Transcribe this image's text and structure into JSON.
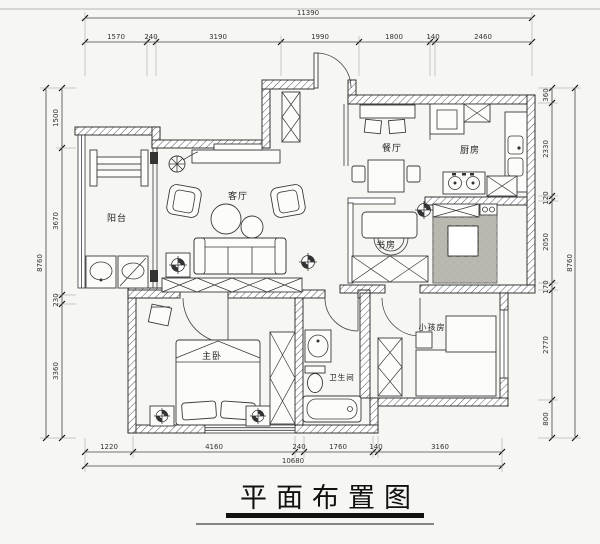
{
  "title": {
    "text": "平面布置图"
  },
  "rooms": {
    "balcony": "阳台",
    "living": "客厅",
    "dining": "餐厅",
    "kitchen": "厨房",
    "study": "书房",
    "master_bedroom": "主卧",
    "bathroom": "卫生间",
    "kids_room": "小孩房"
  },
  "dimensions": {
    "top": {
      "total": "11390",
      "segments": [
        "1570",
        "240",
        "3190",
        "1990",
        "1800",
        "140",
        "2460"
      ]
    },
    "bottom": {
      "total": "10680",
      "segments": [
        "1220",
        "4160",
        "240",
        "1760",
        "140",
        "3160"
      ]
    },
    "left": {
      "total": "8760",
      "segments": [
        "1500",
        "3670",
        "230",
        "3360"
      ]
    },
    "right": {
      "total": "8760",
      "segments": [
        "360",
        "2330",
        "120",
        "2050",
        "170",
        "2770",
        "800"
      ]
    }
  },
  "colors": {
    "ink": "#2b2b2b",
    "paper": "#f6f6f3",
    "tile_fill": "#e0ded6",
    "hatch": "#555555"
  }
}
